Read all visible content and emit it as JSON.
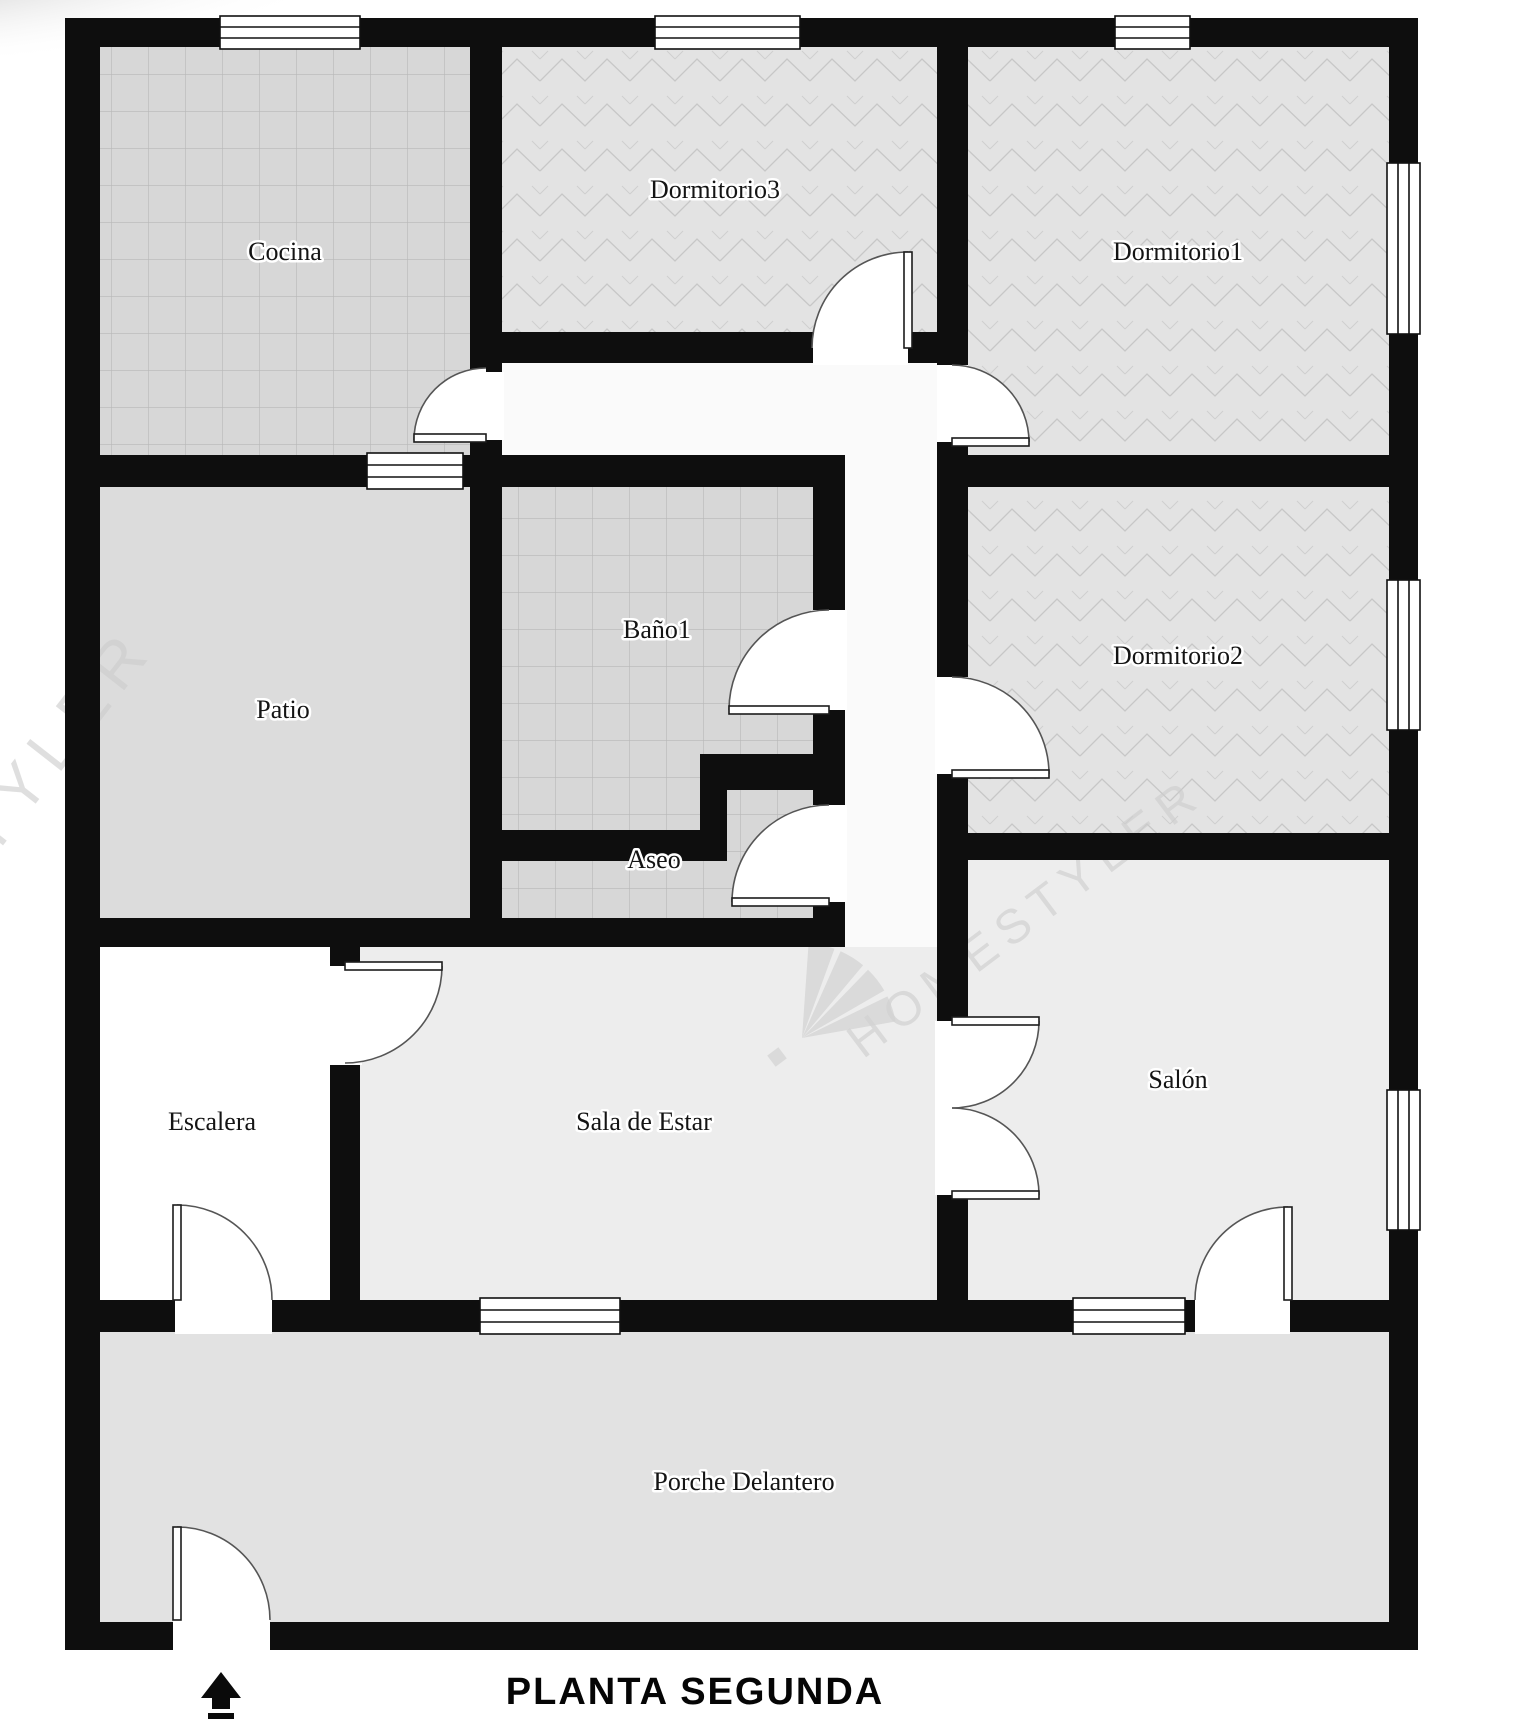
{
  "plan": {
    "title": "PLANTA SEGUNDA"
  },
  "rooms": [
    {
      "id": "cocina",
      "label": "Cocina"
    },
    {
      "id": "dormitorio3",
      "label": "Dormitorio3"
    },
    {
      "id": "dormitorio1",
      "label": "Dormitorio1"
    },
    {
      "id": "patio",
      "label": "Patio"
    },
    {
      "id": "bano1",
      "label": "Baño1"
    },
    {
      "id": "aseo",
      "label": "Aseo"
    },
    {
      "id": "dormitorio2",
      "label": "Dormitorio2"
    },
    {
      "id": "escalera",
      "label": "Escalera"
    },
    {
      "id": "sala",
      "label": "Sala de Estar"
    },
    {
      "id": "salon",
      "label": "Salón"
    },
    {
      "id": "porche",
      "label": "Porche Delantero"
    }
  ],
  "watermark": {
    "main": "HOMESTYLER",
    "left": "STYLER"
  },
  "colors": {
    "wall": "#0e0e0e",
    "tile_floor": "#d7d7d7",
    "wood_floor": "#e3e3e3",
    "plain_floor": "#ededed",
    "patio_floor": "#dcdcdc",
    "porch_floor": "#e2e2e2",
    "watermark": "#cdcdcd"
  }
}
